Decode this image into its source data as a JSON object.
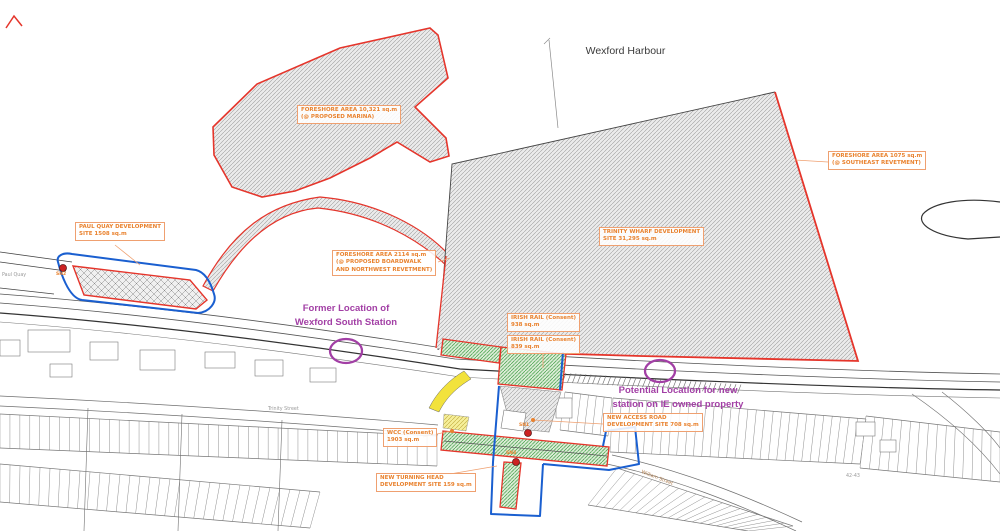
{
  "title": "Wexford Harbour",
  "labels": {
    "marina": {
      "line1": "FORESHORE AREA 10,321 sq.m",
      "line2": "(@ PROPOSED MARINA)"
    },
    "se_revetment": {
      "line1": "FORESHORE AREA 1075 sq.m",
      "line2": "(@ SOUTHEAST REVETMENT)"
    },
    "nw_revetment": {
      "line1": "FORESHORE AREA 2114 sq.m",
      "line2": "(@ PROPOSED BOARDWALK",
      "line3": "AND NORTHWEST REVETMENT)"
    },
    "paul_quay": {
      "line1": "PAUL QUAY DEVELOPMENT",
      "line2": "SITE 1508 sq.m"
    },
    "trinity_wharf": {
      "line1": "TRINITY WHARF DEVELOPMENT",
      "line2": "SITE 31,295 sq.m"
    },
    "irish_rail_north": {
      "line1": "IRISH RAIL (Consent)",
      "line2": "938 sq.m"
    },
    "irish_rail_south": {
      "line1": "IRISH RAIL (Consent)",
      "line2": "839 sq.m"
    },
    "wcc": {
      "line1": "WCC (Consent)",
      "line2": "1903 sq.m"
    },
    "new_access_road": {
      "line1": "NEW ACCESS ROAD",
      "line2": "DEVELOPMENT SITE 708 sq.m"
    },
    "new_turning_head": {
      "line1": "NEW TURNING HEAD",
      "line2": "DEVELOPMENT SITE 159 sq.m"
    }
  },
  "annotations": {
    "former_station": {
      "line1": "Former Location of",
      "line2": "Wexford South Station"
    },
    "potential_station": {
      "line1": "Potential Location for new",
      "line2": "station on IE owned property"
    }
  },
  "survey_markers": {
    "sn1": "SN1",
    "sn2": "SN2",
    "sn3": "SN3"
  },
  "street_names": {
    "paul_quay": "Paul Quay",
    "trinity_street": "Trinity Street",
    "william_street": "William Street",
    "plot_42_43": "42-43"
  },
  "colors": {
    "boundary_red": "#E5352B",
    "consent_blue": "#1A5FD0",
    "hatch_green": "#3F9E45",
    "annotation_purple": "#A23FA5",
    "label_orange": "#E9822E",
    "highlight_yellow": "#F2E23C"
  }
}
